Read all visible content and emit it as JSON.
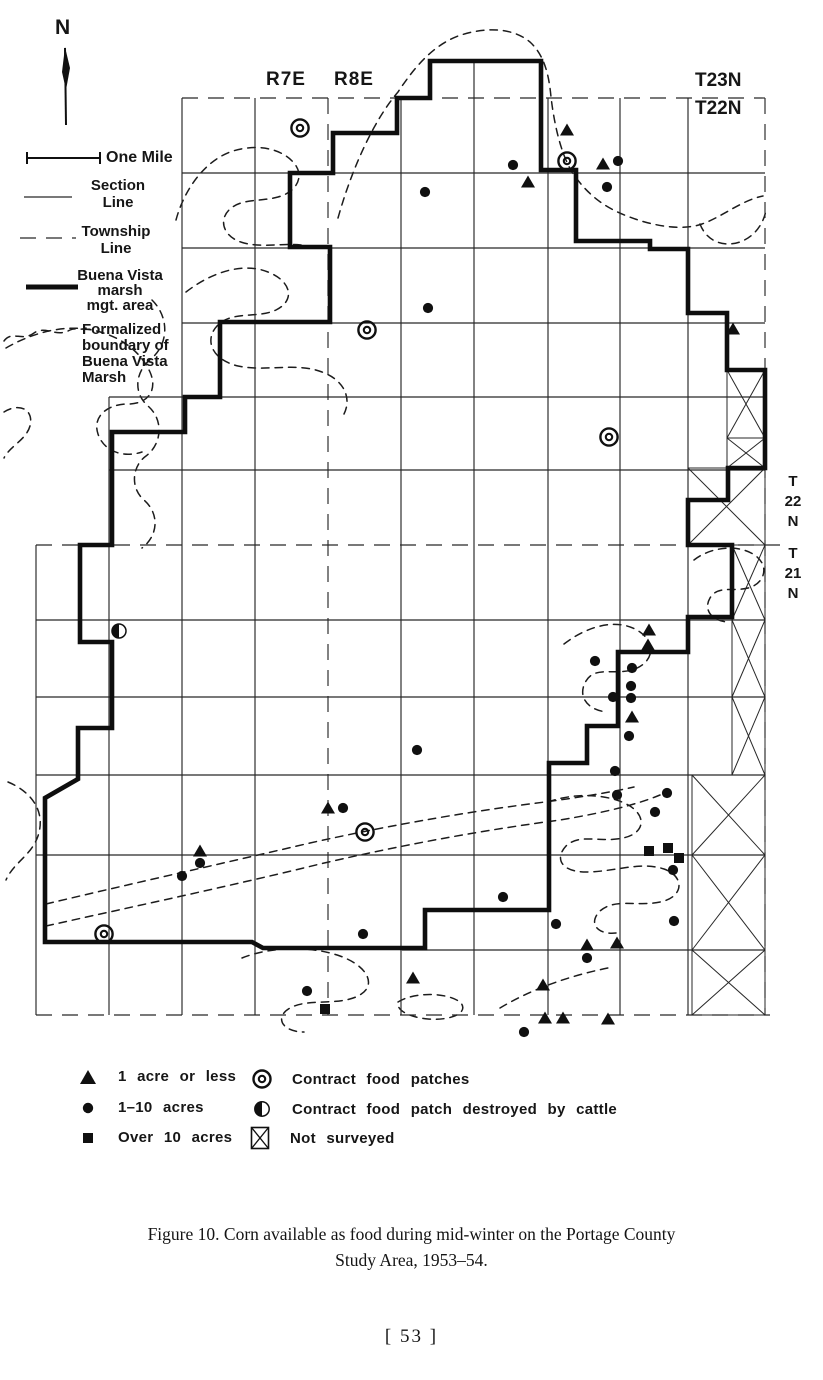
{
  "compass": {
    "label": "N"
  },
  "scale": {
    "label": "One Mile"
  },
  "map_legend": {
    "section": [
      "Section",
      "Line"
    ],
    "township": [
      "Township",
      "Line"
    ],
    "mgmt": [
      "Buena Vista",
      "marsh",
      "mgt. area"
    ],
    "marsh": [
      "Formalized",
      "boundary of",
      "Buena Vista",
      "Marsh"
    ]
  },
  "range_labels": {
    "r7e": "R7E",
    "r8e": "R8E"
  },
  "township_labels": {
    "t23n": "T23N",
    "t22n": "T22N",
    "right_upper": [
      "T",
      "22",
      "N"
    ],
    "right_lower": [
      "T",
      "21",
      "N"
    ]
  },
  "symbol_legend": [
    {
      "icon": "triangle-icon",
      "label": "1 acre or less"
    },
    {
      "icon": "dot-icon",
      "label": "1–10 acres"
    },
    {
      "icon": "square-icon",
      "label": "Over 10 acres"
    },
    {
      "icon": "double-circle-icon",
      "label": "Contract food patches"
    },
    {
      "icon": "half-circle-icon",
      "label": "Contract food patch destroyed by cattle"
    },
    {
      "icon": "not-surveyed-icon",
      "label": "Not surveyed"
    }
  ],
  "caption": {
    "line1": "Figure 10. Corn available as food during mid-winter on the Portage County",
    "line2": "Study Area, 1953–54."
  },
  "page_number": "[ 53 ]",
  "chart_data": {
    "type": "map",
    "title": "Corn available as food during mid-winter on the Portage County Study Area, 1953-54",
    "symbols": {
      "one_acre_or_less": [
        [
          567,
          130
        ],
        [
          603,
          164
        ],
        [
          528,
          182
        ],
        [
          733,
          329
        ],
        [
          649,
          630
        ],
        [
          648,
          645
        ],
        [
          632,
          717
        ],
        [
          328,
          808
        ],
        [
          200,
          851
        ],
        [
          587,
          945
        ],
        [
          617,
          943
        ],
        [
          413,
          978
        ],
        [
          543,
          985
        ],
        [
          545,
          1018
        ],
        [
          563,
          1018
        ],
        [
          608,
          1019
        ]
      ],
      "one_to_ten_acres": [
        [
          513,
          165
        ],
        [
          618,
          161
        ],
        [
          607,
          187
        ],
        [
          425,
          192
        ],
        [
          428,
          308
        ],
        [
          595,
          661
        ],
        [
          632,
          668
        ],
        [
          631,
          686
        ],
        [
          613,
          697
        ],
        [
          631,
          698
        ],
        [
          629,
          736
        ],
        [
          417,
          750
        ],
        [
          615,
          771
        ],
        [
          617,
          795
        ],
        [
          667,
          793
        ],
        [
          655,
          812
        ],
        [
          343,
          808
        ],
        [
          200,
          863
        ],
        [
          182,
          876
        ],
        [
          673,
          870
        ],
        [
          503,
          897
        ],
        [
          674,
          921
        ],
        [
          556,
          924
        ],
        [
          363,
          934
        ],
        [
          587,
          958
        ],
        [
          307,
          991
        ],
        [
          524,
          1032
        ]
      ],
      "over_ten_acres": [
        [
          649,
          851
        ],
        [
          668,
          848
        ],
        [
          679,
          858
        ],
        [
          325,
          1009
        ]
      ],
      "contract_food_patches": [
        [
          300,
          128
        ],
        [
          567,
          161
        ],
        [
          367,
          330
        ],
        [
          609,
          437
        ],
        [
          365,
          832
        ],
        [
          104,
          934
        ]
      ],
      "contract_food_patch_destroyed_by_cattle": [
        [
          119,
          631
        ]
      ]
    }
  },
  "geometry": {
    "view": [
      823,
      1060
    ],
    "grid": {
      "cols": [
        {
          "x": 36,
          "y1": 545,
          "y2": 1015
        },
        {
          "x": 109,
          "y1": 397,
          "y2": 1015
        },
        {
          "x": 182,
          "y1": 98,
          "y2": 1015
        },
        {
          "x": 255,
          "y1": 98,
          "y2": 1015
        },
        {
          "x": 328,
          "y1": 98,
          "y2": 1015,
          "d": 1
        },
        {
          "x": 401,
          "y1": 98,
          "y2": 1015
        },
        {
          "x": 474,
          "y1": 61,
          "y2": 1015
        },
        {
          "x": 548,
          "y1": 98,
          "y2": 1015
        },
        {
          "x": 620,
          "y1": 98,
          "y2": 1015
        },
        {
          "x": 688,
          "y1": 98,
          "y2": 1015
        },
        {
          "x": 765,
          "y1": 98,
          "y2": 1015,
          "d": 1
        }
      ],
      "rows": [
        {
          "y": 98,
          "x1": 182,
          "x2": 765,
          "d": 1
        },
        {
          "y": 173,
          "x1": 182,
          "x2": 765
        },
        {
          "y": 248,
          "x1": 182,
          "x2": 765
        },
        {
          "y": 323,
          "x1": 182,
          "x2": 765
        },
        {
          "y": 397,
          "x1": 109,
          "x2": 765
        },
        {
          "y": 470,
          "x1": 109,
          "x2": 765
        },
        {
          "y": 545,
          "x1": 36,
          "x2": 790,
          "d": 1
        },
        {
          "y": 620,
          "x1": 36,
          "x2": 765
        },
        {
          "y": 697,
          "x1": 36,
          "x2": 765
        },
        {
          "y": 775,
          "x1": 36,
          "x2": 765
        },
        {
          "y": 855,
          "x1": 36,
          "x2": 765
        },
        {
          "y": 950,
          "x1": 402,
          "x2": 765
        },
        {
          "y": 1015,
          "x1": 36,
          "x2": 770,
          "d": 1
        }
      ]
    },
    "boundary": "M430,61 L541,61 L541,170 L576,170 L576,241 L650,241 L650,249 L688,249 L688,313 L727,313 L727,370 L765,370 L765,468 L728,468 L728,500 L688,500 L688,545 L732,545 L732,617 L688,617 L688,652 L618,652 L618,726 L587,726 L587,763 L549,763 L549,910 L425,910 L425,948 L263,948 L252,942 L45,942 L45,798 L78,779 L78,728 L112,728 L112,642 L80,642 L80,545 L112,545 L112,432 L185,432 L185,397 L220,397 L220,322 L330,322 L330,247 L290,247 L290,173 L333,173 L333,133 L397,133 L397,98 L430,98 Z",
    "not_surveyed_cells": [
      [
        727,
        370,
        765,
        438
      ],
      [
        727,
        438,
        765,
        468
      ],
      [
        688,
        468,
        765,
        545
      ],
      [
        732,
        545,
        765,
        620
      ],
      [
        732,
        620,
        765,
        697
      ],
      [
        732,
        697,
        765,
        775
      ],
      [
        692,
        775,
        765,
        855
      ],
      [
        692,
        855,
        765,
        950
      ],
      [
        692,
        950,
        765,
        1015
      ]
    ],
    "marsh_paths": [
      "M338,218 C352,168 374,120 398,92 C414,68 432,46 458,36 C484,27 512,27 530,42 C545,56 549,76 551,97 C554,122 560,152 572,172 C586,193 603,207 627,216 C652,226 682,231 702,224 C722,217 742,200 763,196",
      "M700,224 C706,240 722,248 740,242 C756,236 764,222 766,210",
      "M176,220 C184,190 204,162 230,152 C256,143 281,148 294,163 C305,176 297,192 278,197 C260,202 241,198 229,210 C218,221 224,238 244,243 C268,249 292,240 316,248",
      "M6,348 C30,334 62,324 92,330 C118,335 140,350 150,372 C158,390 148,404 128,404 C108,404 92,416 98,434 C104,452 124,458 142,452",
      "M186,292 C212,272 243,262 268,272 C291,281 296,300 276,310 C257,319 232,310 217,326 C204,340 212,360 238,366 C266,372 296,362 322,372 C344,380 352,398 344,414",
      "M152,300 C170,318 168,344 152,358 C136,370 132,392 148,406 C164,420 162,444 146,456 C132,466 130,488 144,500 C160,514 158,536 142,548",
      "M46,904 C130,884 220,864 310,843 C400,823 480,810 545,802 C582,797 612,792 634,787",
      "M46,926 C136,906 230,886 320,864 C410,843 492,829 560,820 C602,813 636,805 660,795",
      "M242,958 C272,946 312,946 340,956 C368,966 378,986 358,996 C338,1006 308,998 290,1008 C274,1017 282,1032 304,1032",
      "M398,1002 C414,992 446,992 460,1002 C470,1012 452,1021 428,1019 C408,1017 396,1010 398,1002",
      "M548,802 C576,792 610,794 630,806 C648,818 643,834 623,838 C600,843 580,833 566,846 C554,859 562,872 586,872 C614,872 640,861 664,869 C684,876 684,895 664,901 C640,908 616,897 600,911 C588,923 597,935 616,933",
      "M694,560 C712,546 740,544 756,556 C770,567 764,584 748,588 C732,592 718,585 710,598 C703,610 712,622 730,622",
      "M564,644 C590,624 620,618 640,632 C658,645 652,664 632,670 C613,675 595,666 586,681 C577,696 587,710 607,712",
      "M8,782 C32,792 46,812 38,836 C31,856 14,862 6,880",
      "M4,412 C20,402 34,410 30,426 C26,440 10,446 4,458",
      "M500,1008 C530,990 568,976 608,968"
    ],
    "north_arrow": {
      "line": [
        66,
        125,
        65,
        48
      ],
      "flag": "65,47 70,68 66,90 62,72"
    },
    "scale_bar": {
      "line": [
        27,
        158,
        100,
        158
      ],
      "ticks": [
        [
          27,
          152,
          27,
          164
        ],
        [
          100,
          152,
          100,
          164
        ]
      ]
    },
    "legend_samples": {
      "section_line": [
        24,
        197,
        72,
        197
      ],
      "township_line": [
        20,
        238,
        76,
        238
      ],
      "mgmt_line": [
        26,
        287,
        78,
        287
      ],
      "marsh_path": "M4,341 C12,330 22,342 34,333 C46,325 56,338 70,330 C76,327 82,331 86,328"
    }
  }
}
